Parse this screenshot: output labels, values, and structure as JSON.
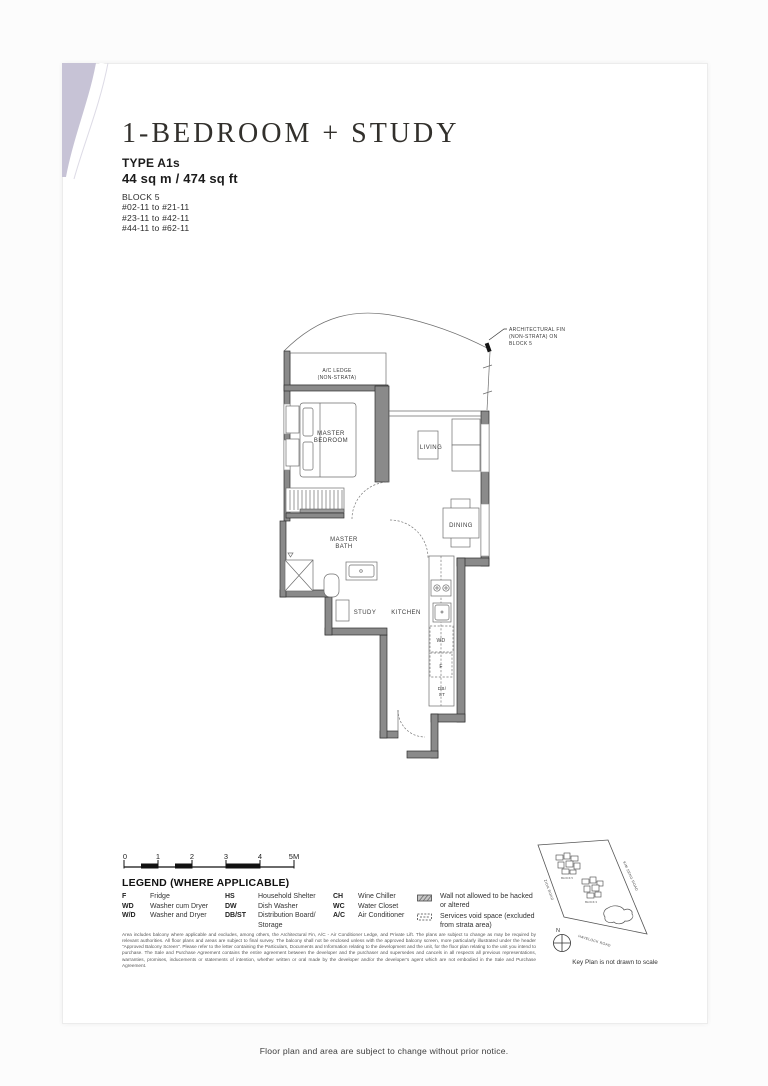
{
  "page": {
    "title": "1-BEDROOM + STUDY",
    "type_label": "TYPE A1s",
    "area": "44 sq m / 474 sq ft",
    "block": "BLOCK 5",
    "units": [
      "#02-11 to #21-11",
      "#23-11 to #42-11",
      "#44-11 to #62-11"
    ],
    "footer_note": "Floor plan and area are subject to change without prior notice."
  },
  "floor_plan": {
    "callout": [
      "ARCHITECTURAL FIN",
      "(NON-STRATA) ON",
      "BLOCK 5"
    ],
    "labels": {
      "ac_ledge": [
        "A/C LEDGE",
        "(NON-STRATA)"
      ],
      "master_bedroom": [
        "MASTER",
        "BEDROOM"
      ],
      "living": [
        "LIVING"
      ],
      "dining": [
        "DINING"
      ],
      "master_bath": [
        "MASTER",
        "BATH"
      ],
      "study": [
        "STUDY"
      ],
      "kitchen": [
        "KITCHEN"
      ],
      "wd": [
        "WD"
      ],
      "fridge": [
        "F"
      ],
      "dbst": [
        "DB/",
        "ST"
      ]
    }
  },
  "scale_bar": {
    "labels": [
      "0",
      "1",
      "2",
      "3",
      "4",
      "5M"
    ]
  },
  "legend": {
    "title": "LEGEND (WHERE APPLICABLE)",
    "columns": [
      [
        {
          "abbr": "F",
          "desc": "Fridge"
        },
        {
          "abbr": "WD",
          "desc": "Washer cum Dryer"
        },
        {
          "abbr": "W/D",
          "desc": "Washer and Dryer"
        }
      ],
      [
        {
          "abbr": "HS",
          "desc": "Household Shelter"
        },
        {
          "abbr": "DW",
          "desc": "Dish Washer"
        },
        {
          "abbr": "DB/ST",
          "desc": "Distribution Board/ Storage"
        }
      ],
      [
        {
          "abbr": "CH",
          "desc": "Wine Chiller"
        },
        {
          "abbr": "WC",
          "desc": "Water Closet"
        },
        {
          "abbr": "A/C",
          "desc": "Air Conditioner"
        }
      ]
    ],
    "symbols": [
      {
        "icon": "hatched-wall",
        "desc": "Wall not allowed to be hacked or altered"
      },
      {
        "icon": "services-void",
        "desc": "Services void space (excluded from strata area)"
      }
    ]
  },
  "key_plan": {
    "roads": {
      "left": "ZION ROAD",
      "top_right": "KIM SENG ROAD",
      "bottom": "HAVELOCK ROAD"
    },
    "blocks": [
      "BLOCK 5",
      "BLOCK 3"
    ],
    "compass": "N",
    "caption": "Key Plan is not drawn to scale"
  },
  "disclaimer": "Area includes balcony where applicable and excludes, among others, the Architectural Fin, A/C - Air Conditioner Ledge, and Private Lift. The plans are subject to change as may be required by relevant authorities. All floor plans and areas are subject to final survey. The balcony shall not be enclosed unless with the approved balcony screen, more particularly illustrated under the header \"Approved Balcony Screen\". Please refer to the letter containing the Particulars, Documents and Information relating to the development and the unit, for the floor plan relating to the unit you intend to purchase. The Sale and Purchase Agreement contains the entire agreement between the developer and the purchaser and supersedes and cancels in all respects all previous representations, warranties, promises, inducements or statements of intention, whether written or oral made by the developer and/or the developer's agent which are not embodied in the Sale and Purchase Agreement."
}
